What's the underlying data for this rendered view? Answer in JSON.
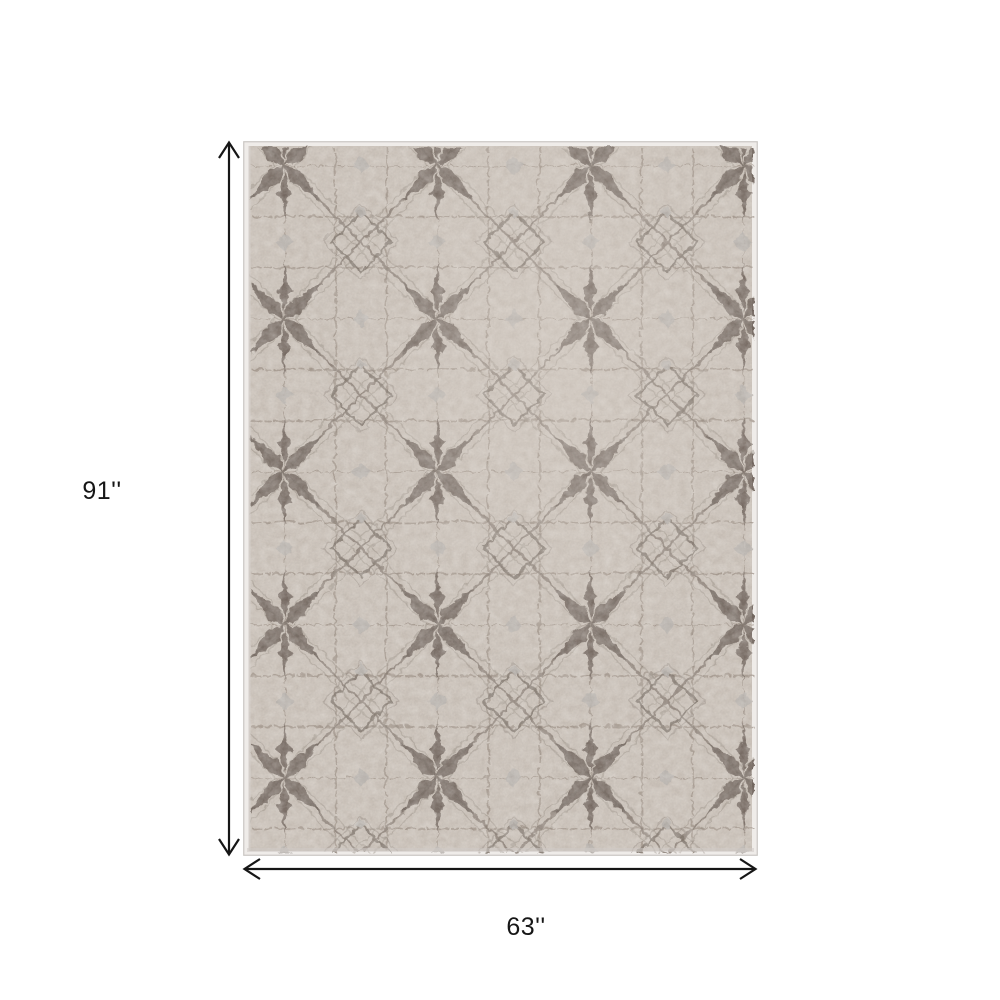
{
  "scene": {
    "type": "product-dimensions-diagram",
    "background_color": "#ffffff"
  },
  "rug": {
    "description": "beige and gray geometric diamond-trellis area rug",
    "field_color": "#cdc4bb",
    "grid_line_color": "#8a7d72",
    "lattice_line_color": "#7b6f65",
    "motif_color": "#6c6057",
    "silver_accent_color": "#bab5b1",
    "binding_color": "#efece9",
    "edge_line_color": "#c9c6c2"
  },
  "annotations": {
    "arrow_color": "#161616",
    "height": {
      "label": "91''"
    },
    "width": {
      "label": "63''"
    }
  }
}
